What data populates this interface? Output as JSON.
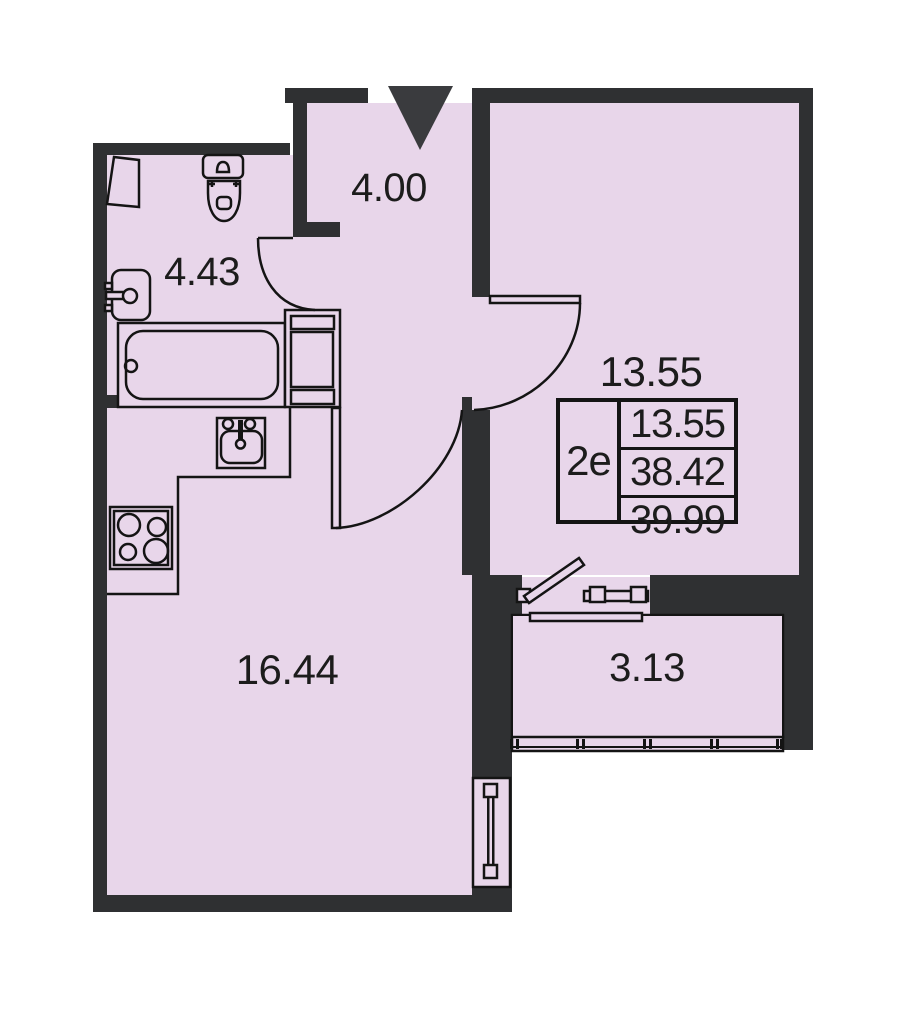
{
  "plan_title": "apartment floor plan",
  "rooms": {
    "hallway": {
      "area": "4.00"
    },
    "bathroom": {
      "area": "4.43"
    },
    "living_room": {
      "area": "13.55"
    },
    "kitchen_living": {
      "area": "16.44"
    },
    "balcony": {
      "area": "3.13"
    }
  },
  "info_table": {
    "unit_type": "2е",
    "rows": [
      "13.55",
      "38.42",
      "39.99"
    ]
  },
  "fixtures": [
    "entry-arrow",
    "toilet",
    "wall-sink",
    "bathtub",
    "corner-shelf",
    "wardrobe",
    "kitchen-counter",
    "kitchen-sink",
    "stove",
    "interior-doors",
    "balcony-door",
    "balcony-glazing",
    "window"
  ],
  "colors": {
    "wall": "#2f3032",
    "room_fill": "#e8d6ea",
    "line": "#141414",
    "entry_arrow": "#3a3b3e",
    "text": "#1c1c1c",
    "background": "#ffffff"
  }
}
